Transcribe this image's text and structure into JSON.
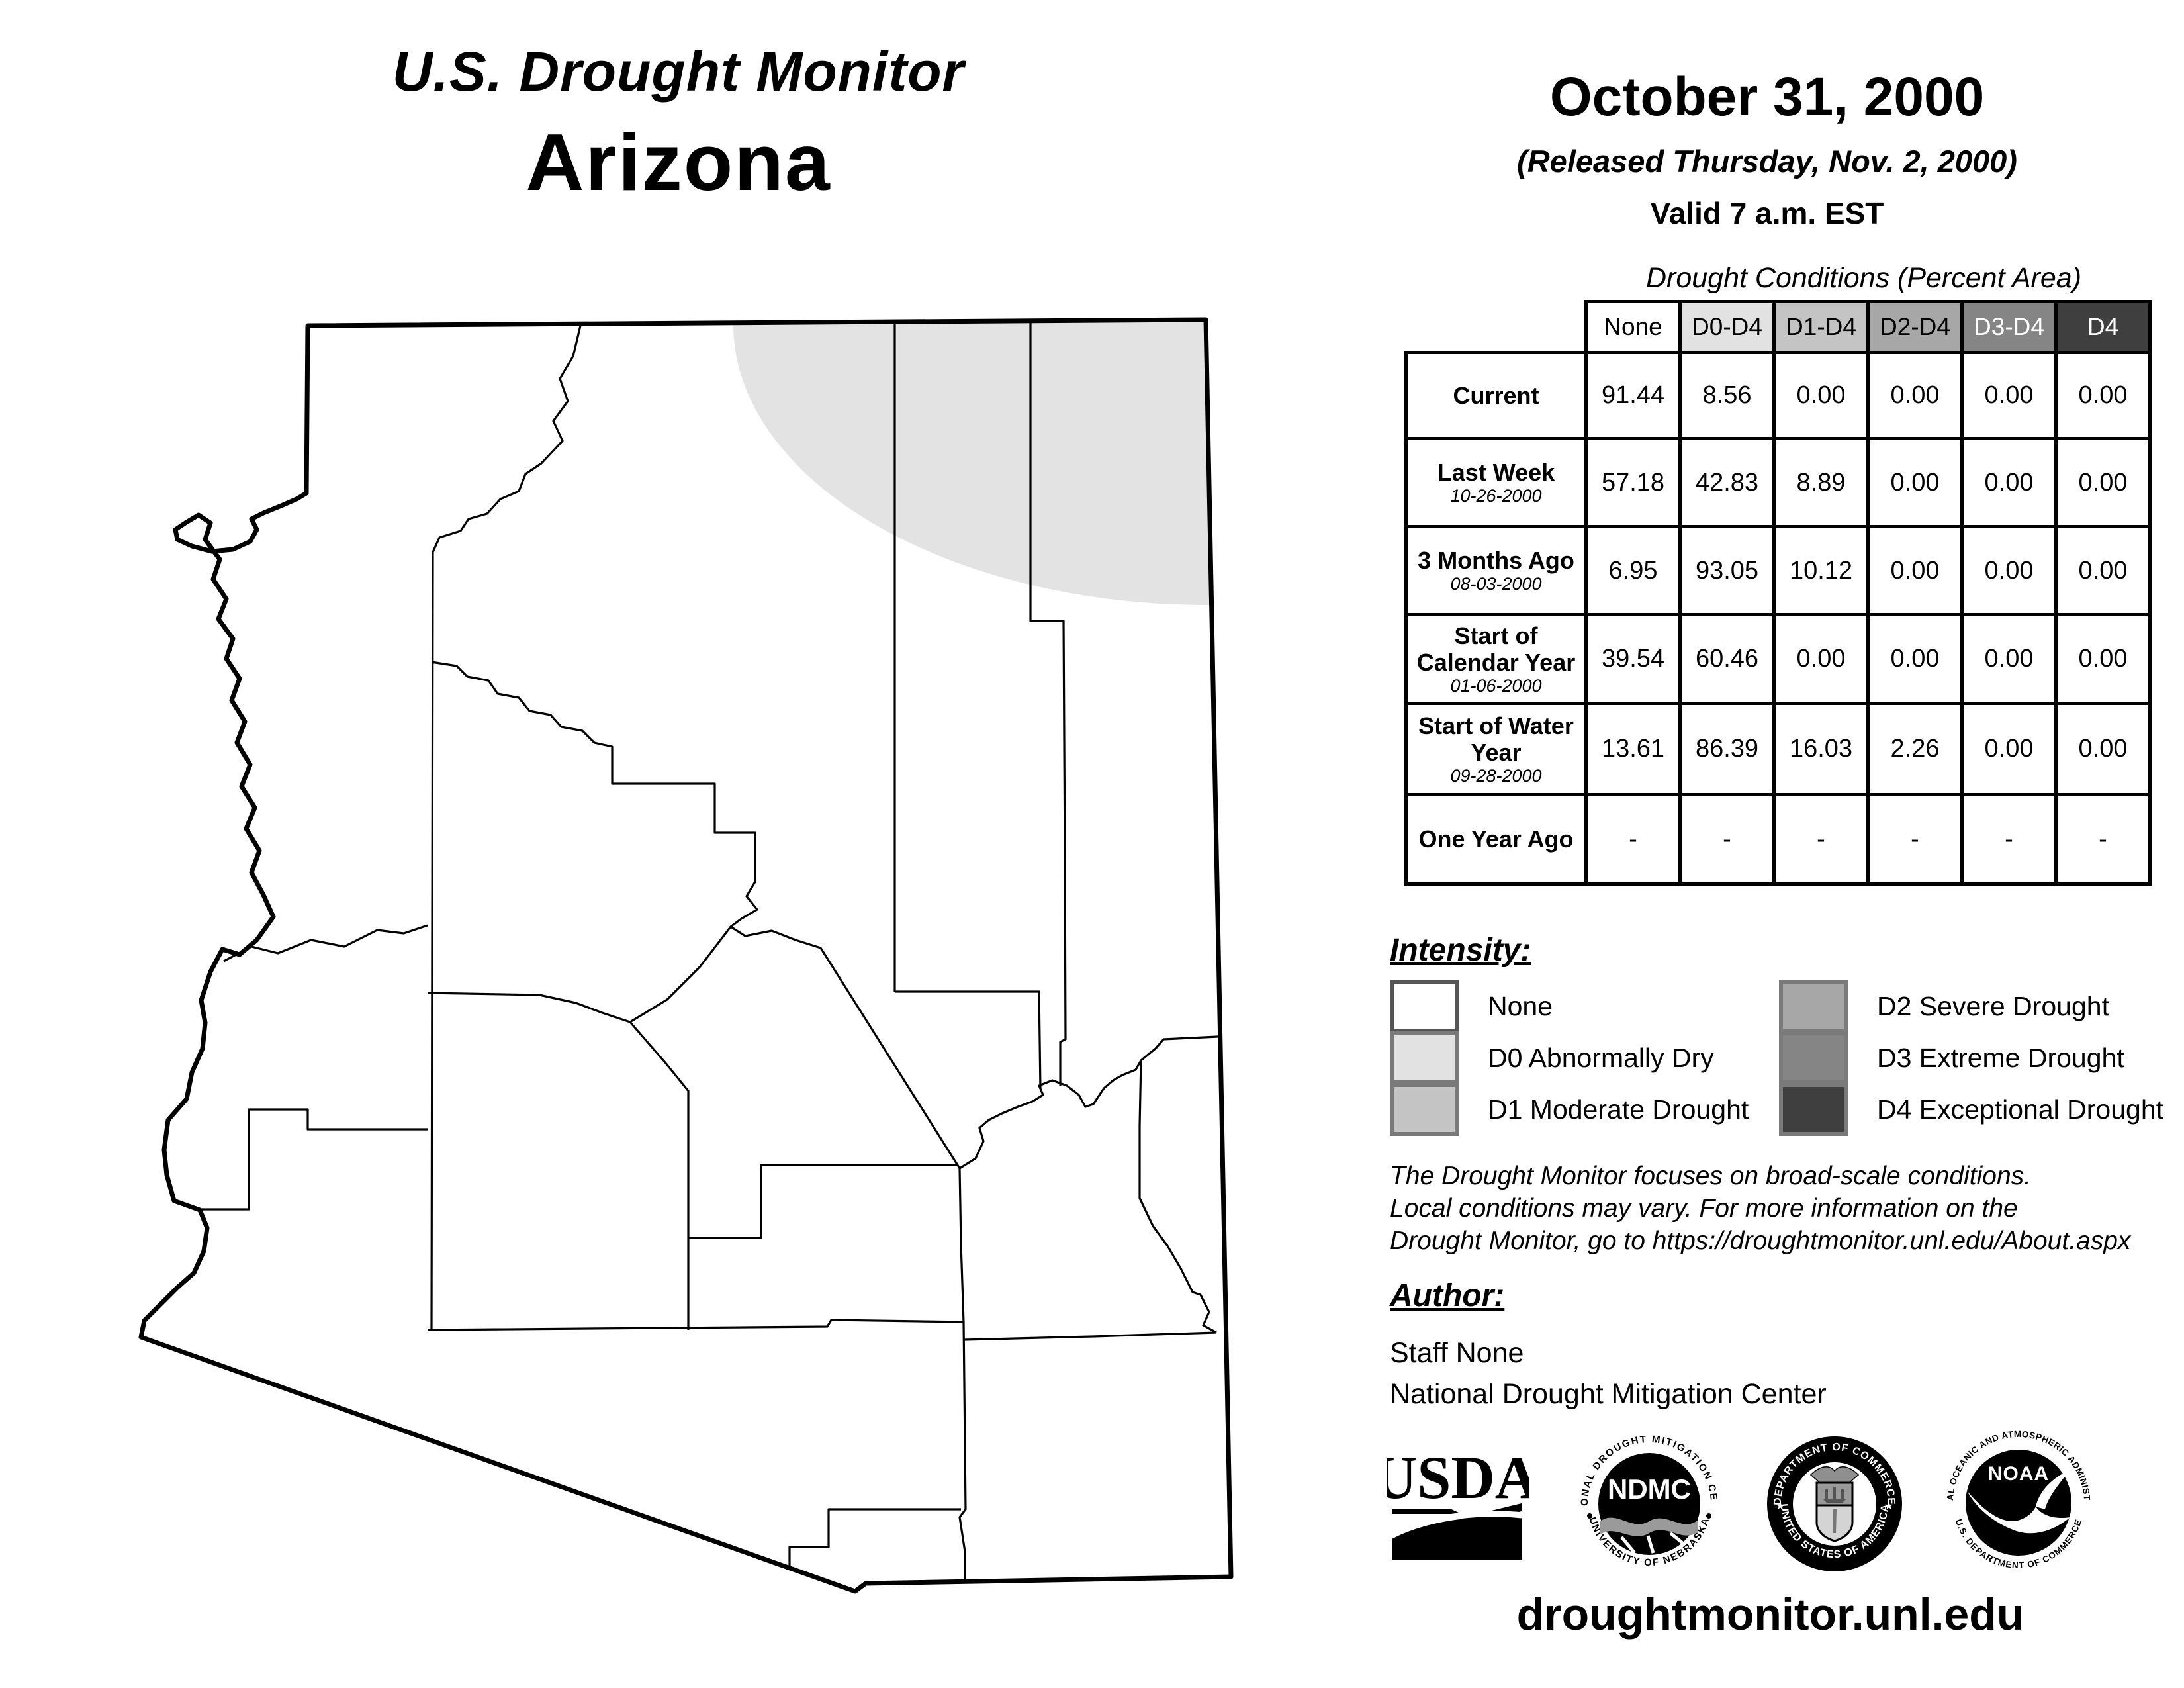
{
  "title": {
    "program": "U.S. Drought Monitor",
    "region": "Arizona"
  },
  "date_block": {
    "date": "October 31, 2000",
    "released": "(Released Thursday, Nov. 2, 2000)",
    "valid": "Valid 7 a.m. EST"
  },
  "table": {
    "title": "Drought Conditions (Percent Area)",
    "columns": [
      "None",
      "D0-D4",
      "D1-D4",
      "D2-D4",
      "D3-D4",
      "D4"
    ],
    "header_colors": [
      "#ffffff",
      "#e2e2e2",
      "#c4c4c4",
      "#a7a7a7",
      "#858585",
      "#3f3f3f"
    ],
    "rows": [
      {
        "label": "Current",
        "date": "",
        "values": [
          "91.44",
          "8.56",
          "0.00",
          "0.00",
          "0.00",
          "0.00"
        ]
      },
      {
        "label": "Last Week",
        "date": "10-26-2000",
        "values": [
          "57.18",
          "42.83",
          "8.89",
          "0.00",
          "0.00",
          "0.00"
        ]
      },
      {
        "label": "3 Months Ago",
        "date": "08-03-2000",
        "values": [
          "6.95",
          "93.05",
          "10.12",
          "0.00",
          "0.00",
          "0.00"
        ]
      },
      {
        "label": "Start of Calendar Year",
        "date": "01-06-2000",
        "values": [
          "39.54",
          "60.46",
          "0.00",
          "0.00",
          "0.00",
          "0.00"
        ]
      },
      {
        "label": "Start of Water Year",
        "date": "09-28-2000",
        "values": [
          "13.61",
          "86.39",
          "16.03",
          "2.26",
          "0.00",
          "0.00"
        ]
      },
      {
        "label": "One Year Ago",
        "date": "",
        "values": [
          "-",
          "-",
          "-",
          "-",
          "-",
          "-"
        ]
      }
    ]
  },
  "legend": {
    "heading": "Intensity:",
    "items": [
      {
        "label": "None",
        "color": "#ffffff"
      },
      {
        "label": "D0 Abnormally Dry",
        "color": "#e2e2e2"
      },
      {
        "label": "D1 Moderate Drought",
        "color": "#c4c4c4"
      },
      {
        "label": "D2 Severe Drought",
        "color": "#a7a7a7"
      },
      {
        "label": "D3 Extreme Drought",
        "color": "#858585"
      },
      {
        "label": "D4 Exceptional Drought",
        "color": "#3f3f3f"
      }
    ]
  },
  "disclaimer": {
    "line1": "The Drought Monitor focuses on broad-scale conditions.",
    "line2": "Local conditions may vary. For more information on the",
    "line3": "Drought Monitor, go to https://droughtmonitor.unl.edu/About.aspx"
  },
  "author": {
    "heading": "Author:",
    "name": "Staff None",
    "org": "National Drought Mitigation Center"
  },
  "logos": {
    "usda": "USDA",
    "ndmc_center": "NDMC",
    "ndmc_ring_top": "NATIONAL DROUGHT MITIGATION CENTER",
    "ndmc_ring_bottom": "UNIVERSITY OF NEBRASKA",
    "commerce_ring_top": "DEPARTMENT OF COMMERCE",
    "commerce_ring_bottom": "UNITED STATES OF AMERICA",
    "noaa_center": "NOAA",
    "noaa_ring_top": "NATIONAL OCEANIC AND ATMOSPHERIC ADMINISTRATION",
    "noaa_ring_bottom": "U.S. DEPARTMENT OF COMMERCE"
  },
  "footer": {
    "url": "droughtmonitor.unl.edu"
  },
  "map": {
    "region": "Arizona",
    "d0_area_color": "#e3e3e3",
    "no_drought_color": "#ffffff",
    "border_color": "#000000",
    "d0_area_location": "northeast corner"
  }
}
